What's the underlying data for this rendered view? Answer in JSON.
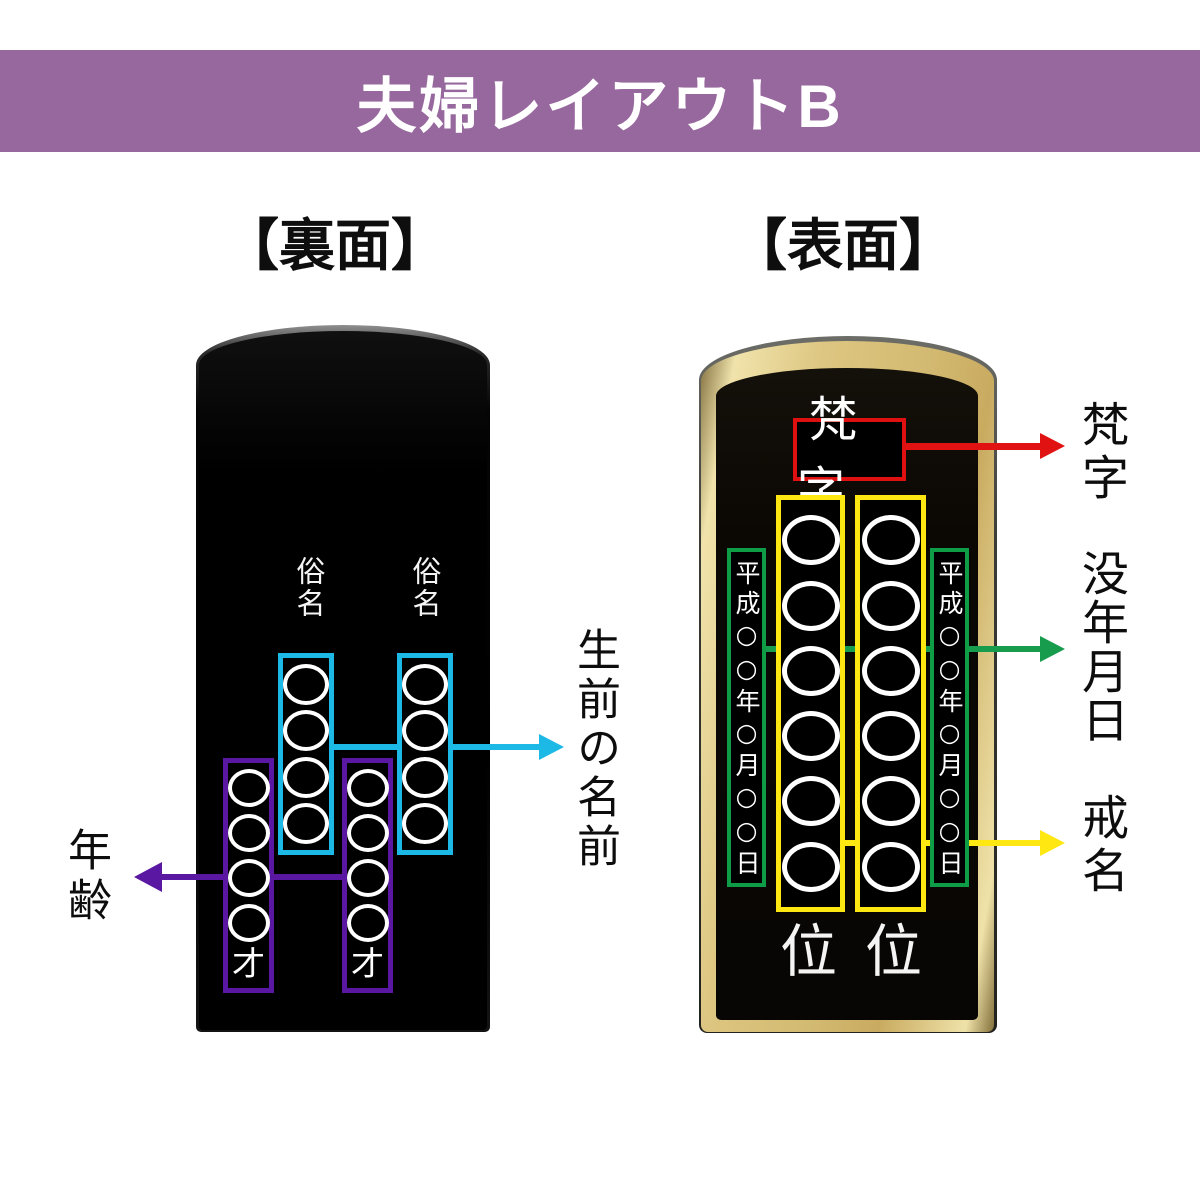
{
  "banner": {
    "title": "夫婦レイアウトB"
  },
  "back": {
    "heading": "【裏面】",
    "zokumyo_left": "俗名",
    "zokumyo_right": "俗名",
    "name_rings": 4,
    "age_rings": 4,
    "sai_left": "才",
    "sai_right": "才",
    "callout_name": "生前の名前",
    "callout_age": "年齢"
  },
  "front": {
    "heading": "【表面】",
    "bonji": "梵字",
    "kaimyo_rings": 6,
    "date_left": "平成○○年○月○○日",
    "date_right": "平成○○年○月○○日",
    "rank_left": "位",
    "rank_right": "位",
    "callout_bonji": "梵字",
    "callout_death_date": "没年月日",
    "callout_kaimyo": "戒名"
  },
  "colors": {
    "banner_bg": "#97689D",
    "name_accent": "#1CB9E7",
    "age_accent": "#5A18A2",
    "bonji_accent": "#DE1010",
    "date_accent": "#0E9C46",
    "kaimyo_accent": "#FFE712",
    "tablet_gold": "#D9C27B",
    "tablet_black": "#000000"
  }
}
